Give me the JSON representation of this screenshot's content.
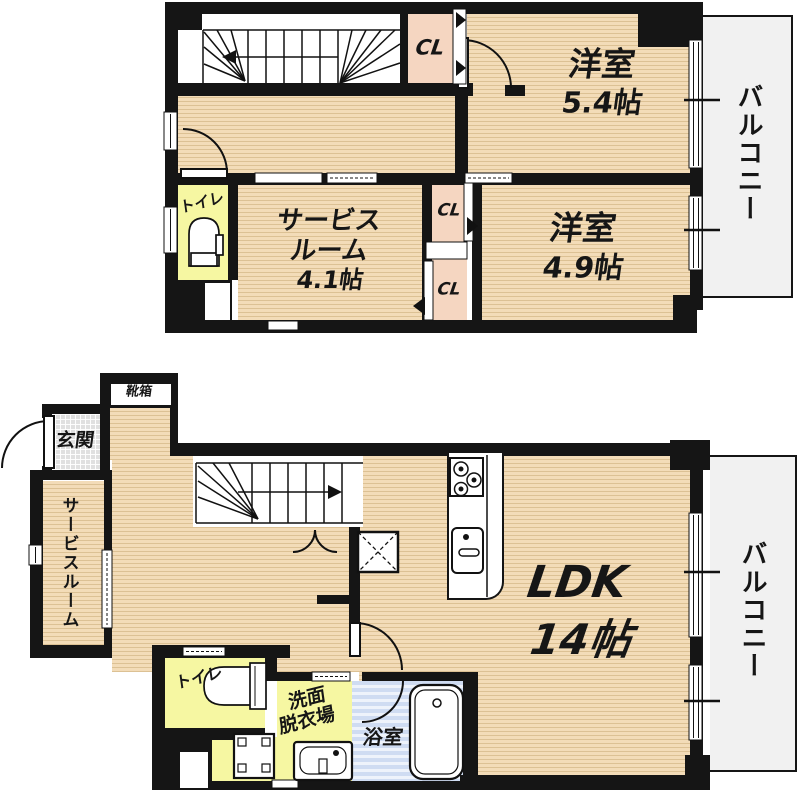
{
  "floor2": {
    "closet1": "CL",
    "closet2": "CL",
    "closet3": "CL",
    "room54_name": "洋室",
    "room54_size": "5.4帖",
    "room49_name": "洋室",
    "room49_size": "4.9帖",
    "service_line1": "サービス",
    "service_line2": "ルーム",
    "service_line3": "4.1帖",
    "toilet": "トイレ",
    "balcony": "バルコニー"
  },
  "floor1": {
    "shoebox": "靴箱",
    "entrance": "玄関",
    "service_room": "サービスルーム",
    "toilet": "トイレ",
    "washroom_line1": "洗面",
    "washroom_line2": "脱衣場",
    "bath": "浴室",
    "ldk_name": "LDK",
    "ldk_size": "14帖",
    "balcony": "バルコニー"
  },
  "colors": {
    "wall": "#151515",
    "room_floor": "#f3dcb8",
    "closet_fill": "#f5d6c1",
    "wet_area_yellow": "#f6f7a2",
    "bath_blue": "#cfdcf2",
    "balcony_gray": "#f1f1f1",
    "entrance_tile": "#e0e0e0"
  }
}
